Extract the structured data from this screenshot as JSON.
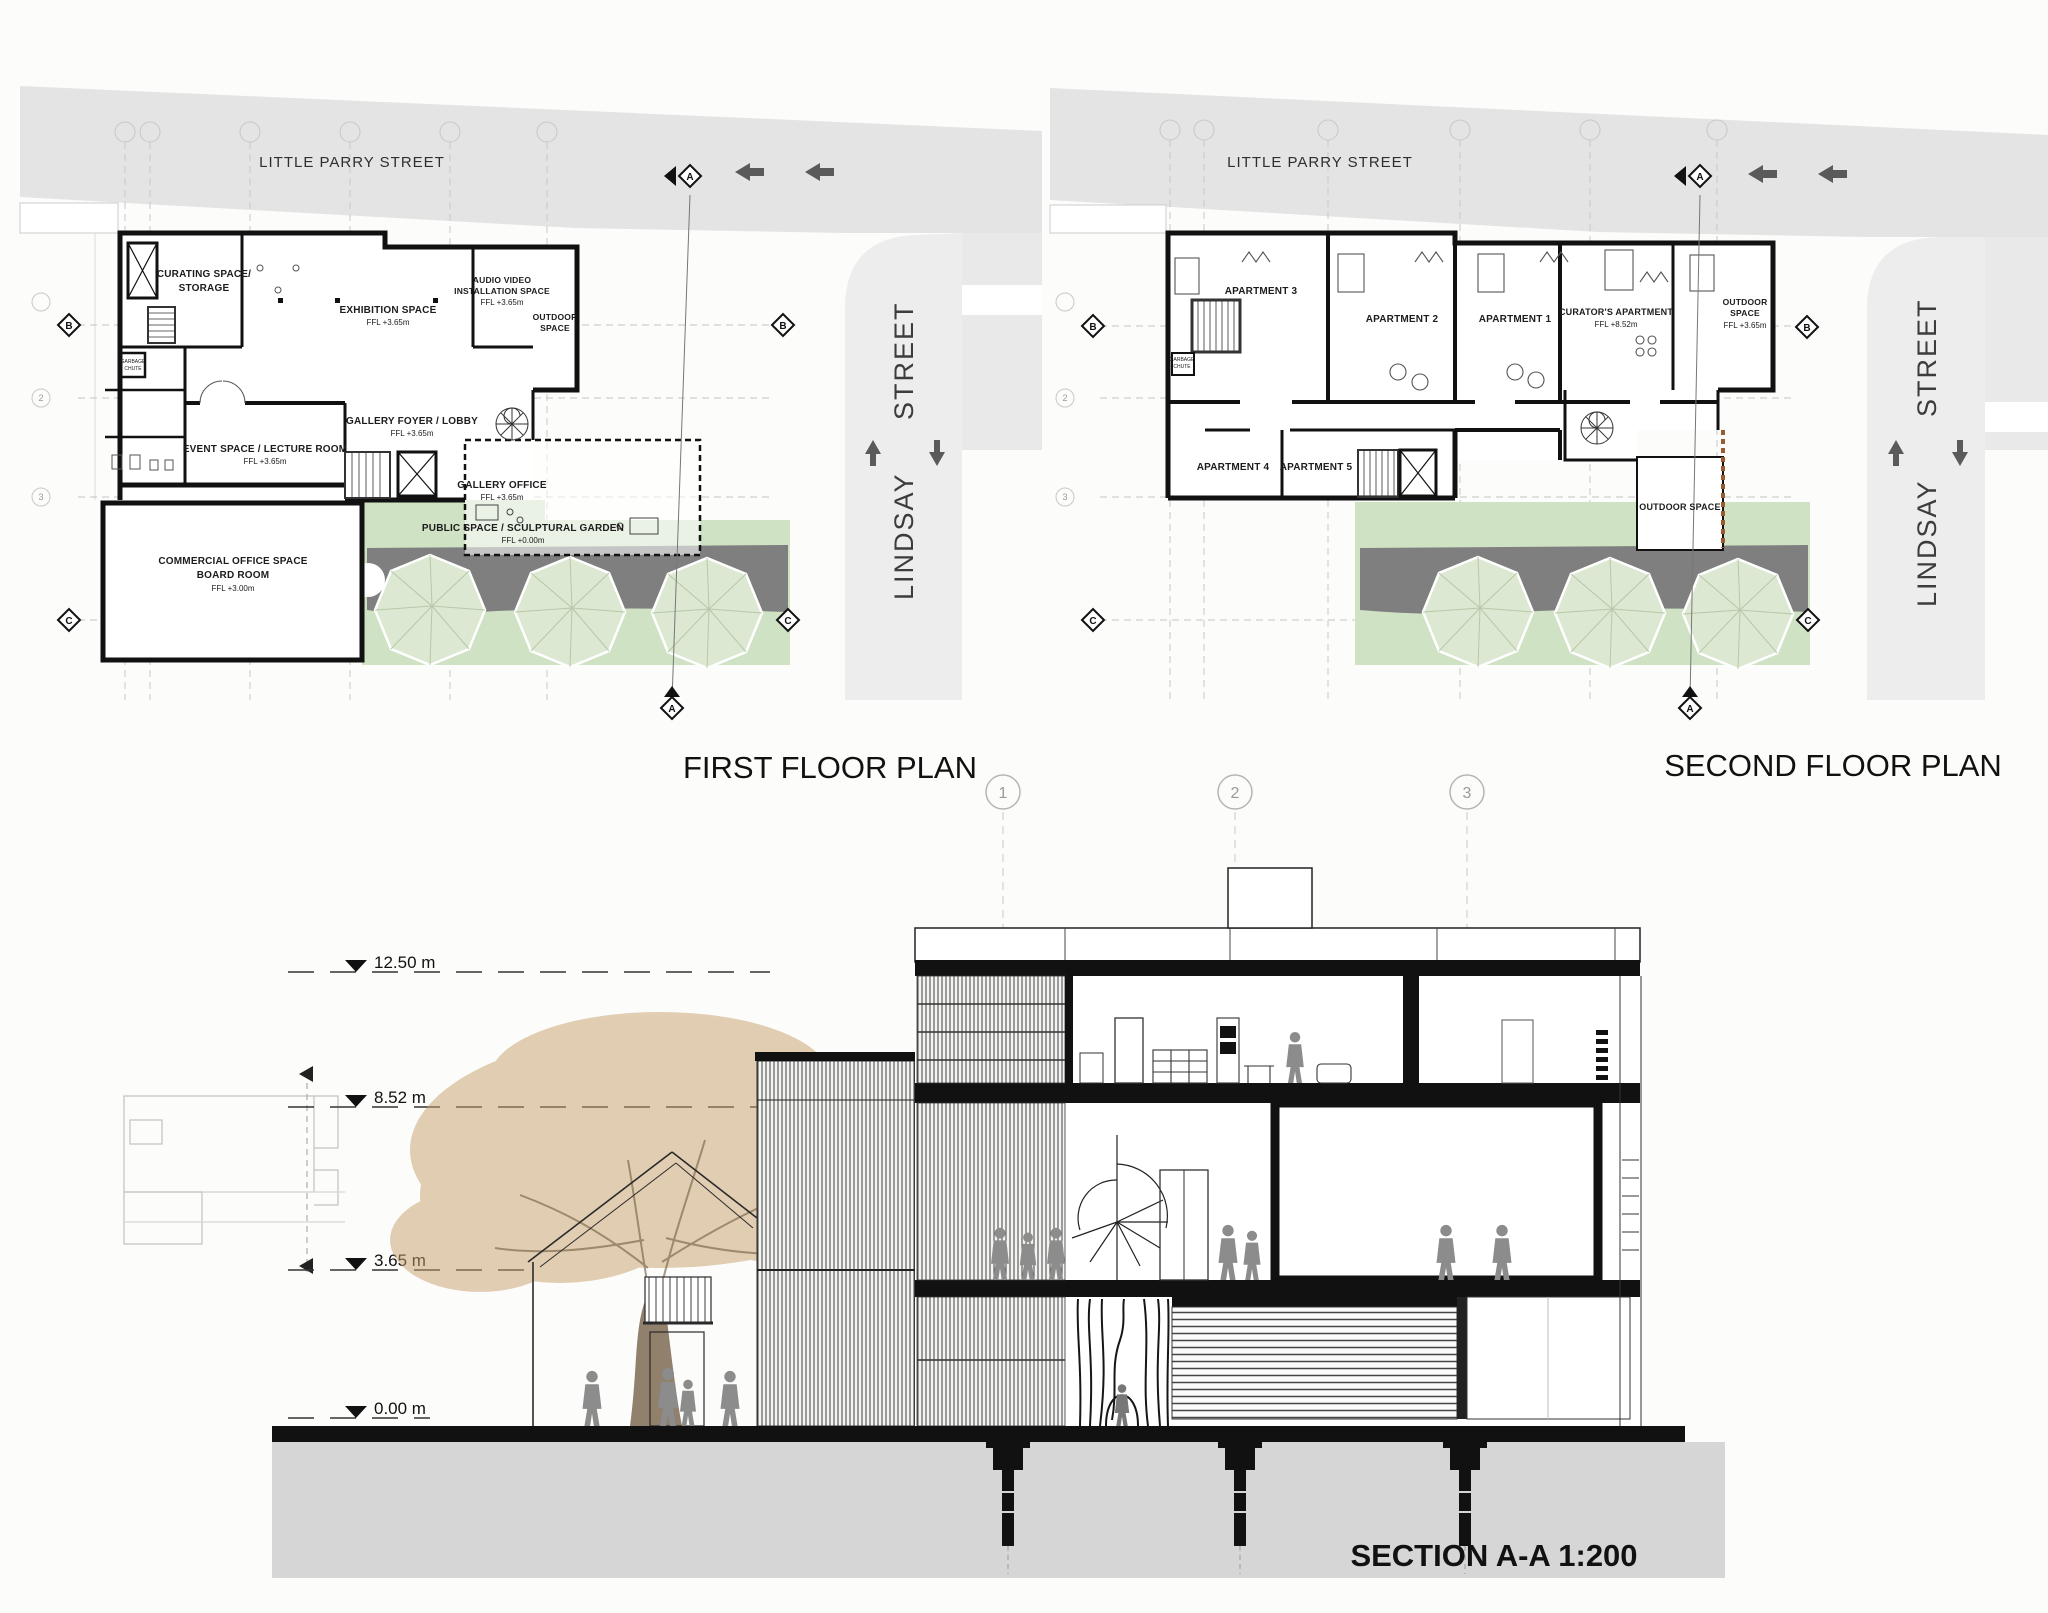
{
  "colors": {
    "street_gray": "#e4e4e4",
    "lindsay_gray": "#ededed",
    "garden_green": "#cfe2c4",
    "tree_green": "#dce8d1",
    "path_gray": "#7f7f7f",
    "soil_gray": "#d6d6d6",
    "canopy_tan": "#c7a06b",
    "wall_black": "#111111",
    "figure_gray": "#8c8c8c",
    "cutline_brown": "#9a5b33"
  },
  "titles": {
    "first": "FIRST FLOOR PLAN",
    "second": "SECOND FLOOR PLAN",
    "section": "SECTION A-A 1:200"
  },
  "streets": {
    "parry": "LITTLE PARRY STREET",
    "lindsay": "LINDSAY",
    "street": "STREET"
  },
  "grid": {
    "a": "A",
    "b": "B",
    "c": "C",
    "n2": "2",
    "n3": "3"
  },
  "p1": {
    "curating_l1": "CURATING SPACE/",
    "curating_l2": "STORAGE",
    "exhibition_l1": "EXHIBITION SPACE",
    "exhibition_ffl": "FFL +3.65m",
    "audio_l1": "AUDIO VIDEO",
    "audio_l2": "INSTALLATION SPACE",
    "audio_ffl": "FFL +3.65m",
    "outdoor_l1": "OUTDOOR",
    "outdoor_l2": "SPACE",
    "foyer_l1": "GALLERY FOYER / LOBBY",
    "foyer_ffl": "FFL +3.65m",
    "event_l1": "EVENT SPACE / LECTURE ROOM",
    "event_ffl": "FFL +3.65m",
    "office_l1": "GALLERY OFFICE",
    "office_ffl": "FFL +3.65m",
    "public_l1": "PUBLIC SPACE / SCULPTURAL GARDEN",
    "public_ffl": "FFL +0.00m",
    "commercial_l1": "COMMERCIAL OFFICE SPACE",
    "commercial_l2": "BOARD ROOM",
    "commercial_ffl": "FFL +3.00m",
    "garbage_l1": "GARBAGE",
    "garbage_l2": "CHUTE"
  },
  "p2": {
    "apt1": "APARTMENT 1",
    "apt2": "APARTMENT 2",
    "apt3": "APARTMENT 3",
    "apt4": "APARTMENT 4",
    "apt5": "APARTMENT 5",
    "curator_l1": "CURATOR'S APARTMENT",
    "curator_ffl": "FFL +8.52m",
    "outdoor_top_l1": "OUTDOOR",
    "outdoor_top_l2": "SPACE",
    "outdoor_top_ffl": "FFL +3.65m",
    "outdoor_low": "OUTDOOR SPACE",
    "garbage_l1": "GARBAGE",
    "garbage_l2": "CHUTE"
  },
  "section": {
    "levels": [
      {
        "label": "12.50 m"
      },
      {
        "label": "8.52 m"
      },
      {
        "label": "3.65 m"
      },
      {
        "label": "0.00 m"
      }
    ],
    "bubbles": [
      "1",
      "2",
      "3"
    ]
  }
}
